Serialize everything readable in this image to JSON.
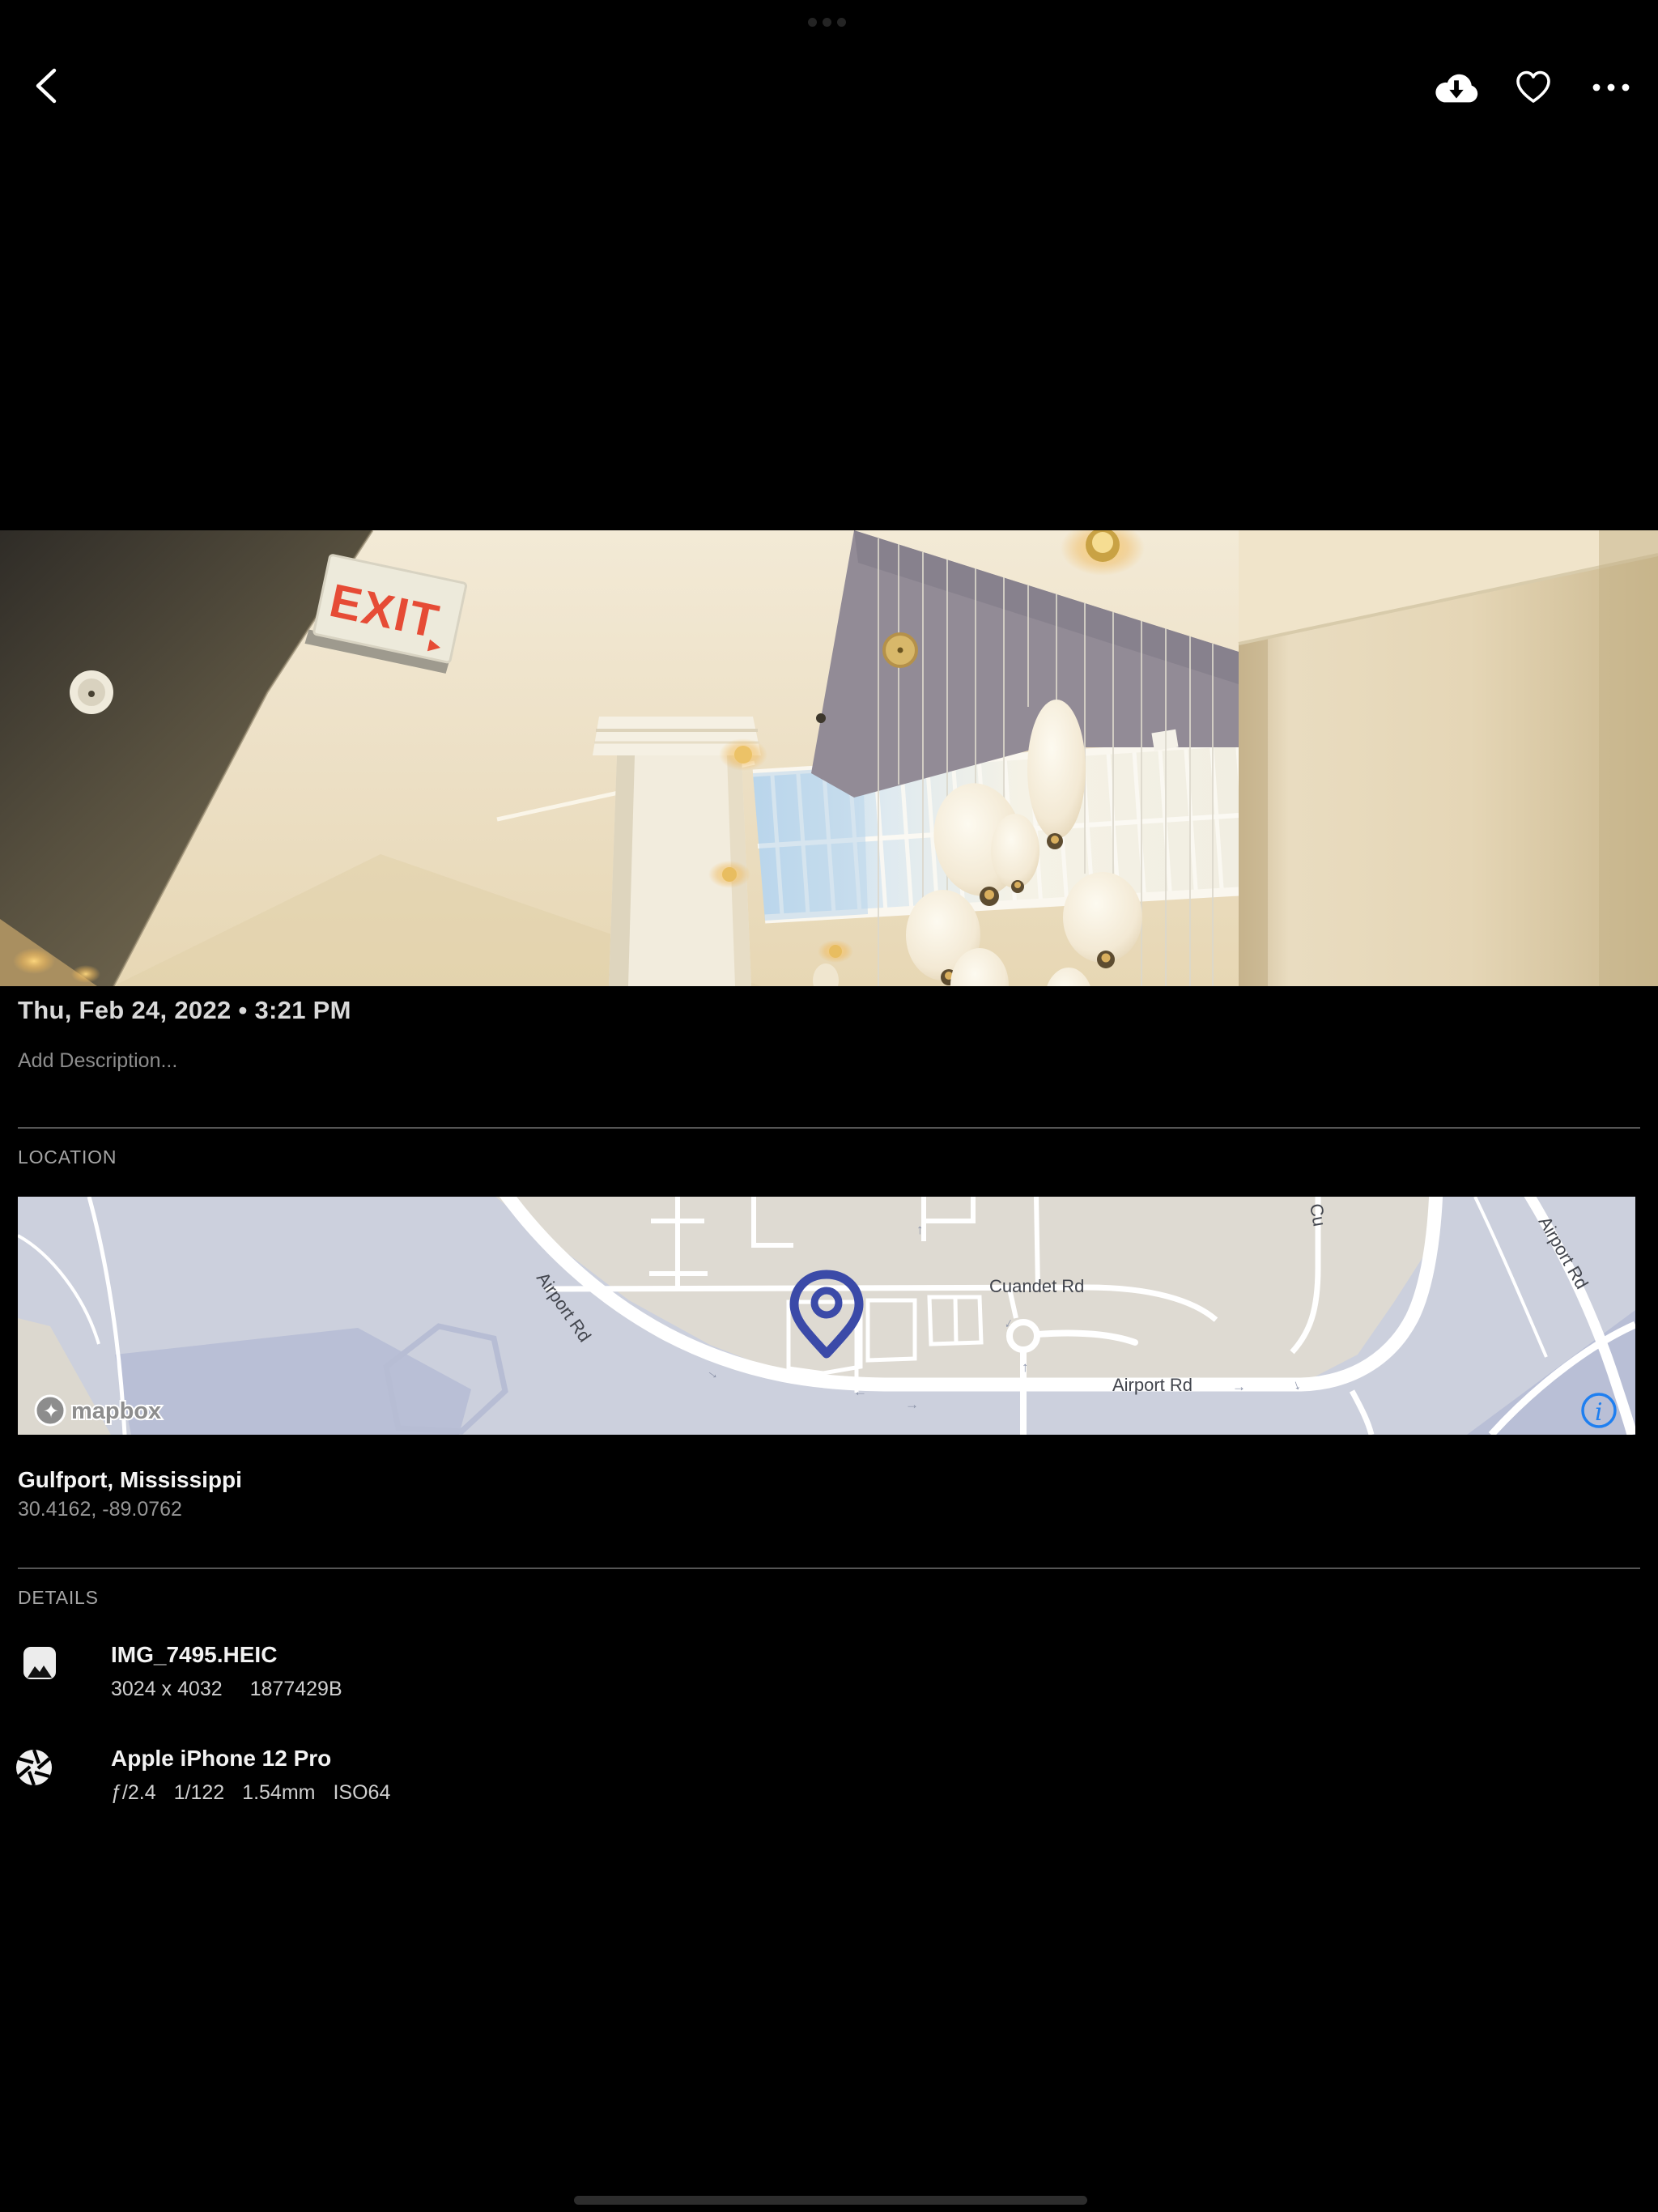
{
  "system": {
    "multitask_pill": "•••"
  },
  "topbar": {
    "back_icon": "chevron-left",
    "download_icon": "cloud-download",
    "favorite_icon": "heart-outline",
    "more_icon": "ellipsis-horizontal"
  },
  "photo": {
    "exit_sign_word": "EXIT",
    "exit_sign_arrow": "▸"
  },
  "meta": {
    "date": "Thu, Feb 24, 2022 • 3:21 PM",
    "description_placeholder": "Add Description..."
  },
  "location": {
    "header": "LOCATION",
    "place": "Gulfport, Mississippi",
    "coordinates": "30.4162, -89.0762",
    "map": {
      "labels": {
        "airport_rd_diagonal": "Airport Rd",
        "cuandet_rd": "Cuandet Rd",
        "airport_rd_bottom": "Airport Rd",
        "airport_rd_topright": "Airport Rd",
        "cross_st_topright": "Cu"
      },
      "attribution": "mapbox",
      "info_glyph": "i",
      "pin_color": "#3b4aa8",
      "land_color": "#dedad2",
      "water_color": "#ccd0dd",
      "road_color": "#ffffff"
    }
  },
  "details": {
    "header": "DETAILS",
    "file": {
      "icon": "image-icon",
      "name": "IMG_7495.HEIC",
      "dimensions": "3024 x 4032",
      "size_bytes": "1877429B"
    },
    "camera": {
      "icon": "aperture-icon",
      "model": "Apple iPhone 12 Pro",
      "aperture": "ƒ/2.4",
      "shutter": "1/122",
      "focal_length": "1.54mm",
      "iso": "ISO64"
    }
  }
}
